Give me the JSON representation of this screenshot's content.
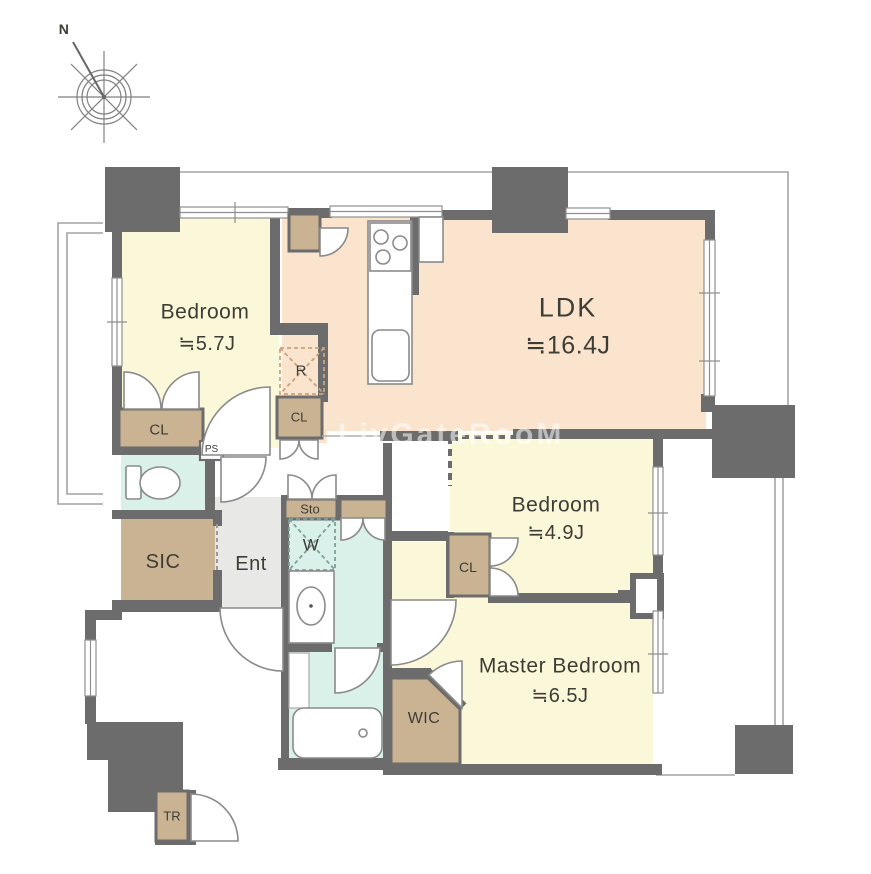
{
  "compass": {
    "north_label": "N"
  },
  "watermark": "LivGateRooM",
  "rooms": {
    "bedroom1": {
      "name": "Bedroom",
      "area": "≒5.7J"
    },
    "ldk": {
      "name": "LDK",
      "area": "≒16.4J"
    },
    "bedroom2": {
      "name": "Bedroom",
      "area": "≒4.9J"
    },
    "master": {
      "name": "Master Bedroom",
      "area": "≒6.5J"
    },
    "sic": {
      "label": "SIC"
    },
    "ent": {
      "label": "Ent"
    },
    "wic": {
      "label": "WIC"
    }
  },
  "labels": {
    "cl1": "CL",
    "cl2": "CL",
    "cl3": "CL",
    "ps": "PS",
    "r": "R",
    "sto": "Sto",
    "w": "W",
    "tr": "TR"
  },
  "colors": {
    "wall": "#6c6c6c",
    "bedroom": "#fbf8da",
    "ldk": "#fae4cd",
    "closet": "#cab393",
    "wet": "#daf1ea",
    "entfloor": "#e8e8e6"
  }
}
